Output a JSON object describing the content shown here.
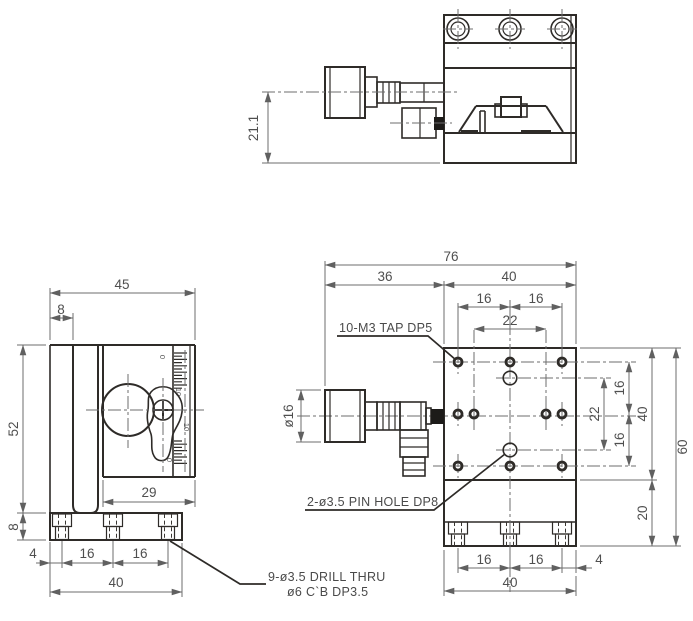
{
  "palette": {
    "ink": "#2e2b28",
    "dim_gray": "#6e6e6e",
    "text_gray": "#4f4f4f",
    "background": "#ffffff"
  },
  "side": {
    "height": "21.1"
  },
  "front": {
    "overall_width": "45",
    "bracket_thickness": "8",
    "column_height": "52",
    "base_thickness": "8",
    "top_block_width": "29",
    "edge_offset": "4",
    "pitch_a": "16",
    "pitch_b": "16",
    "base_width": "40",
    "scale_zero_top": "0",
    "scale_ten_upper": "10",
    "scale_ten_lower": "10",
    "scale_zero_bottom": "0"
  },
  "plan": {
    "overall_width": "76",
    "knob_section": "36",
    "plate_width": "40",
    "pitch_top_left": "16",
    "pitch_top_right": "16",
    "span_top_inner": "22",
    "knob_diameter": "ø16",
    "pitch_right_top": "16",
    "span_right_inner": "22",
    "pitch_right_bottom": "16",
    "plate_depth": "40",
    "overall_depth": "60",
    "base_depth": "20",
    "pitch_bottom_left": "16",
    "pitch_bottom_right": "16",
    "edge_bottom": "4",
    "base_width": "40"
  },
  "callouts": {
    "tap_holes": "10-M3 TAP DP5",
    "pin_holes": "2-ø3.5 PIN HOLE DP8",
    "drill_note_line1": "9-ø3.5 DRILL THRU",
    "drill_note_line2": "ø6 C`B DP3.5"
  }
}
